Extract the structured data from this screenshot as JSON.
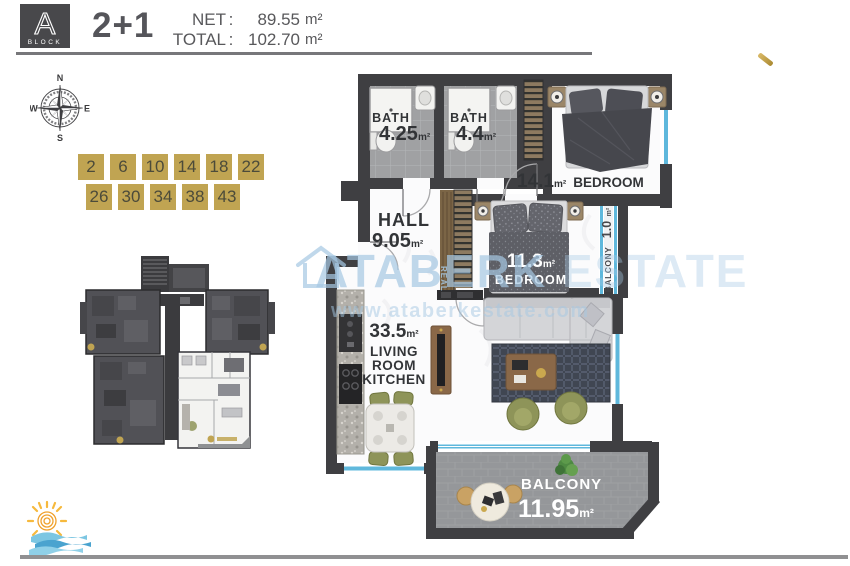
{
  "header": {
    "block_letter": "A",
    "block_word": "BLOCK",
    "unit_type": "2+1",
    "net_label": "NET",
    "total_label": "TOTAL",
    "sep": ":",
    "net_value": "89.55",
    "total_value": "102.70",
    "area_unit": "m²"
  },
  "compass": {
    "north": "N",
    "east": "E",
    "south": "S",
    "west": "W"
  },
  "floor_numbers": {
    "row1": [
      "2",
      "6",
      "10",
      "14",
      "18",
      "22"
    ],
    "row2": [
      "26",
      "30",
      "34",
      "38",
      "43"
    ]
  },
  "units": {
    "m2": "m²"
  },
  "rooms": {
    "bath1": {
      "name": "BATH",
      "area": "4.25"
    },
    "bath2": {
      "name": "BATH",
      "area": "4.4"
    },
    "bedroom1": {
      "area": "14.1",
      "name": "BEDROOM"
    },
    "hall": {
      "name": "HALL",
      "area": "9.05"
    },
    "bedroom2": {
      "area": "11.3",
      "name": "BEDROOM"
    },
    "balcony_side": {
      "name": "BALCONY",
      "area": "1.0"
    },
    "living": {
      "area": "33.5",
      "line1": "LIVING",
      "line2": "ROOM",
      "line3": "KITCHEN"
    },
    "balcony_main": {
      "name": "BALCONY",
      "area": "11.95"
    }
  },
  "watermark": {
    "brand_primary": "ATABERK",
    "brand_secondary": "ESTATE",
    "small_label": "REAL",
    "url": "www.ataberkestate.com"
  },
  "colors": {
    "gold": "#c0a452",
    "wall": "#3f3f42",
    "window_blue": "#5fb8dc",
    "watermark_blue": "#a6c8e3"
  }
}
